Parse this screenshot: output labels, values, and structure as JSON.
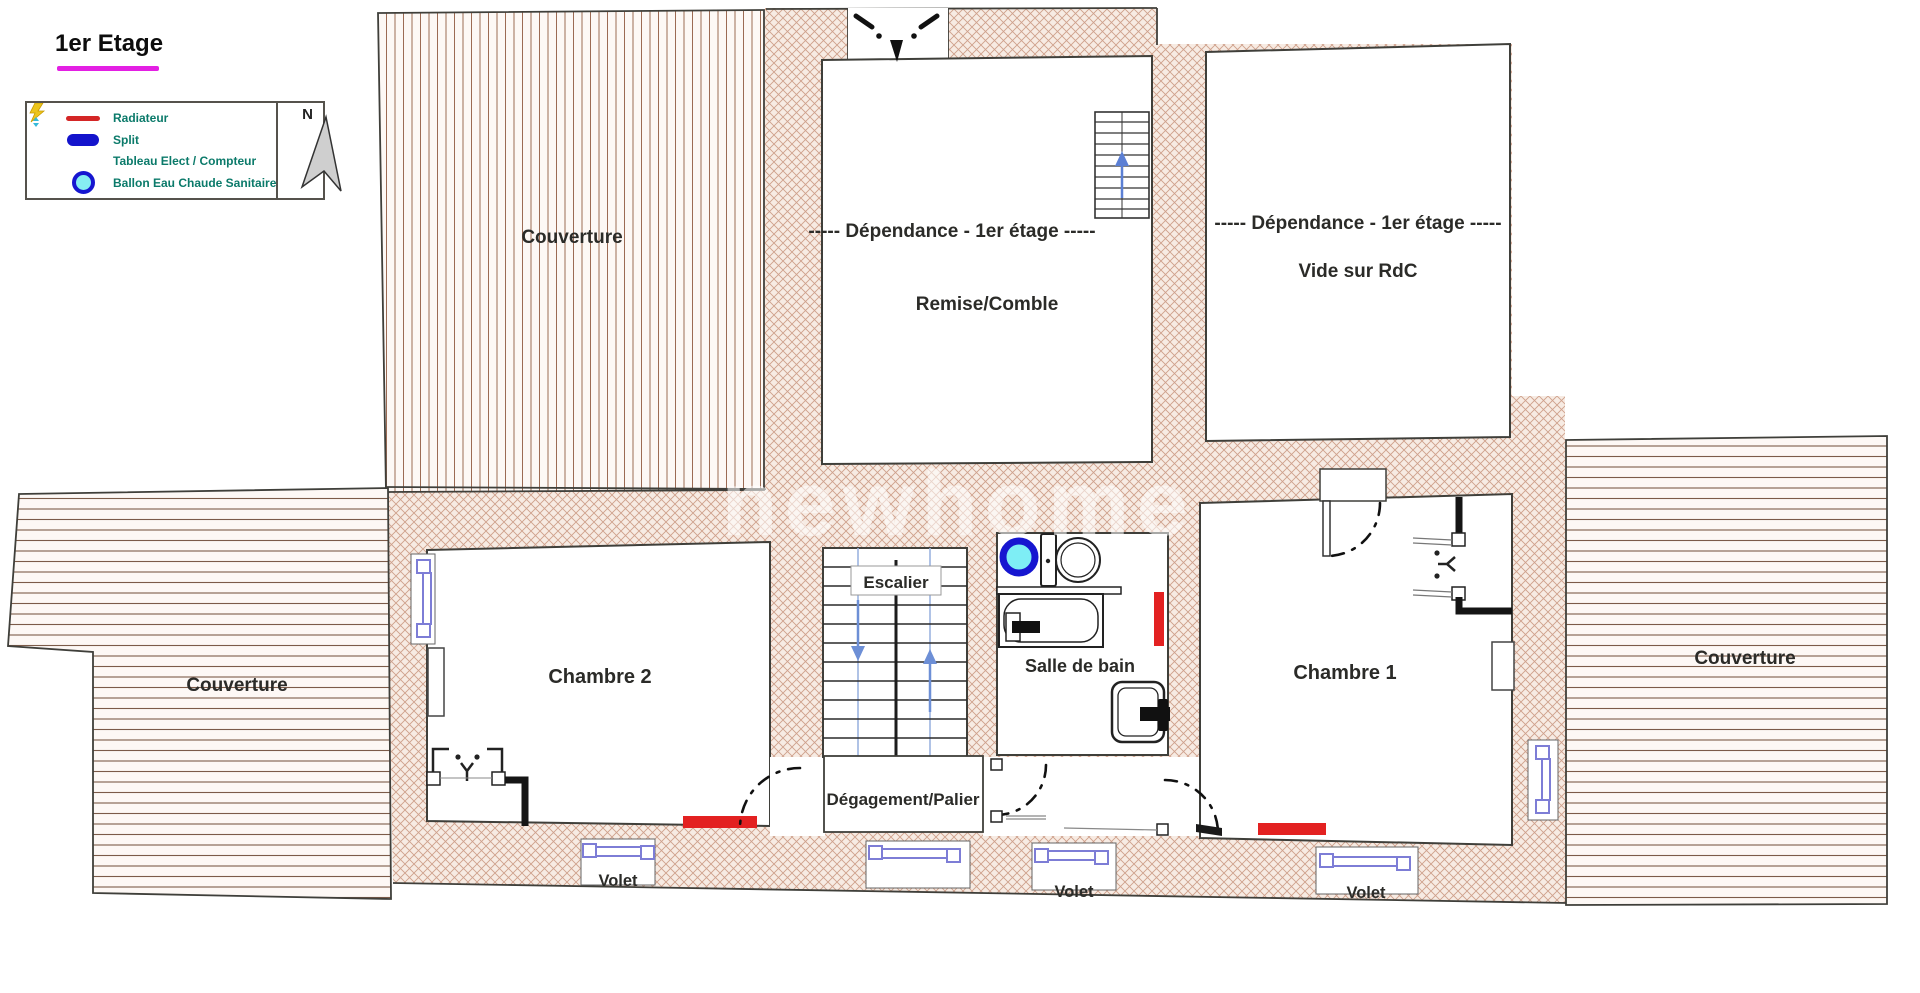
{
  "title": {
    "text": "1er Etage"
  },
  "legend": {
    "compass": "N",
    "items": [
      {
        "label": "Radiateur",
        "icon": "radiator-line",
        "color": "#d42626"
      },
      {
        "label": "Split",
        "icon": "split-pill",
        "color": "#1414cc"
      },
      {
        "label": "Tableau Elect / Compteur",
        "icon": "lightning-bolt",
        "color": "#ecc51c"
      },
      {
        "label": "Ballon Eau Chaude Sanitaire",
        "icon": "water-heater-circle",
        "color": "#1616d0"
      }
    ]
  },
  "watermark": "newhome",
  "labels": {
    "couverture_top": "Couverture",
    "couverture_left": "Couverture",
    "couverture_right": "Couverture",
    "remise_title": "-----  Dépendance - 1er étage  -----",
    "remise_name": "Remise/Comble",
    "vide_title": "-----  Dépendance - 1er étage  -----",
    "vide_name": "Vide sur RdC",
    "chambre2": "Chambre 2",
    "chambre1": "Chambre 1",
    "escalier": "Escalier",
    "salle_de_bain": "Salle de bain",
    "degagement": "Dégagement/Palier",
    "volet_1": "Volet",
    "volet_2": "Volet",
    "volet_3": "Volet"
  },
  "colors": {
    "accent_underline": "#e31fe3",
    "legend_text": "#0b7a6a",
    "radiator": "#e32121",
    "window": "#7d7dd6",
    "ballon_ring": "#1616d0",
    "ballon_fill": "#7eeef5",
    "wall_hatch": "#cfa08b",
    "roof_hatch": "#7c5b49"
  }
}
